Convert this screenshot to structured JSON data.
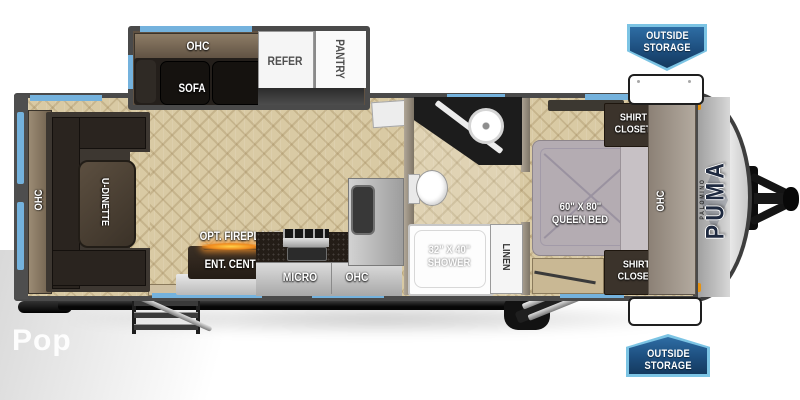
{
  "watermark": "Pop",
  "brand": {
    "name": "PUMA",
    "maker": "PALOMINO"
  },
  "badges": {
    "top": {
      "line1": "OUTSIDE",
      "line2": "STORAGE"
    },
    "bottom": {
      "line1": "OUTSIDE",
      "line2": "STORAGE"
    }
  },
  "labels": {
    "ohc_slide": "OHC",
    "sofa": "SOFA",
    "refer": "REFER",
    "pantry": "PANTRY",
    "ohc_rear": "OHC",
    "u_dinette": "U-DINETTE",
    "opt_fireplace": "OPT. FIREPLACE",
    "ent_center": "ENT. CENTER",
    "micro": "MICRO",
    "ohc_kitchen": "OHC",
    "shower_size": "32\" X 40\"",
    "shower": "SHOWER",
    "linen": "LINEN",
    "bed_size": "60\" X 80\"",
    "bed": "QUEEN BED",
    "shirt_closet": {
      "line1": "SHIRT",
      "line2": "CLOSET"
    },
    "ohc_bedroom": "OHC"
  },
  "colors": {
    "accent_blue": "#74b2dd",
    "badge_navy": "#1d4e7e",
    "badge_light_blue": "#7cc4e4",
    "wall_gray": "#4a4a4a",
    "floor_tan": "#d9caa4"
  }
}
